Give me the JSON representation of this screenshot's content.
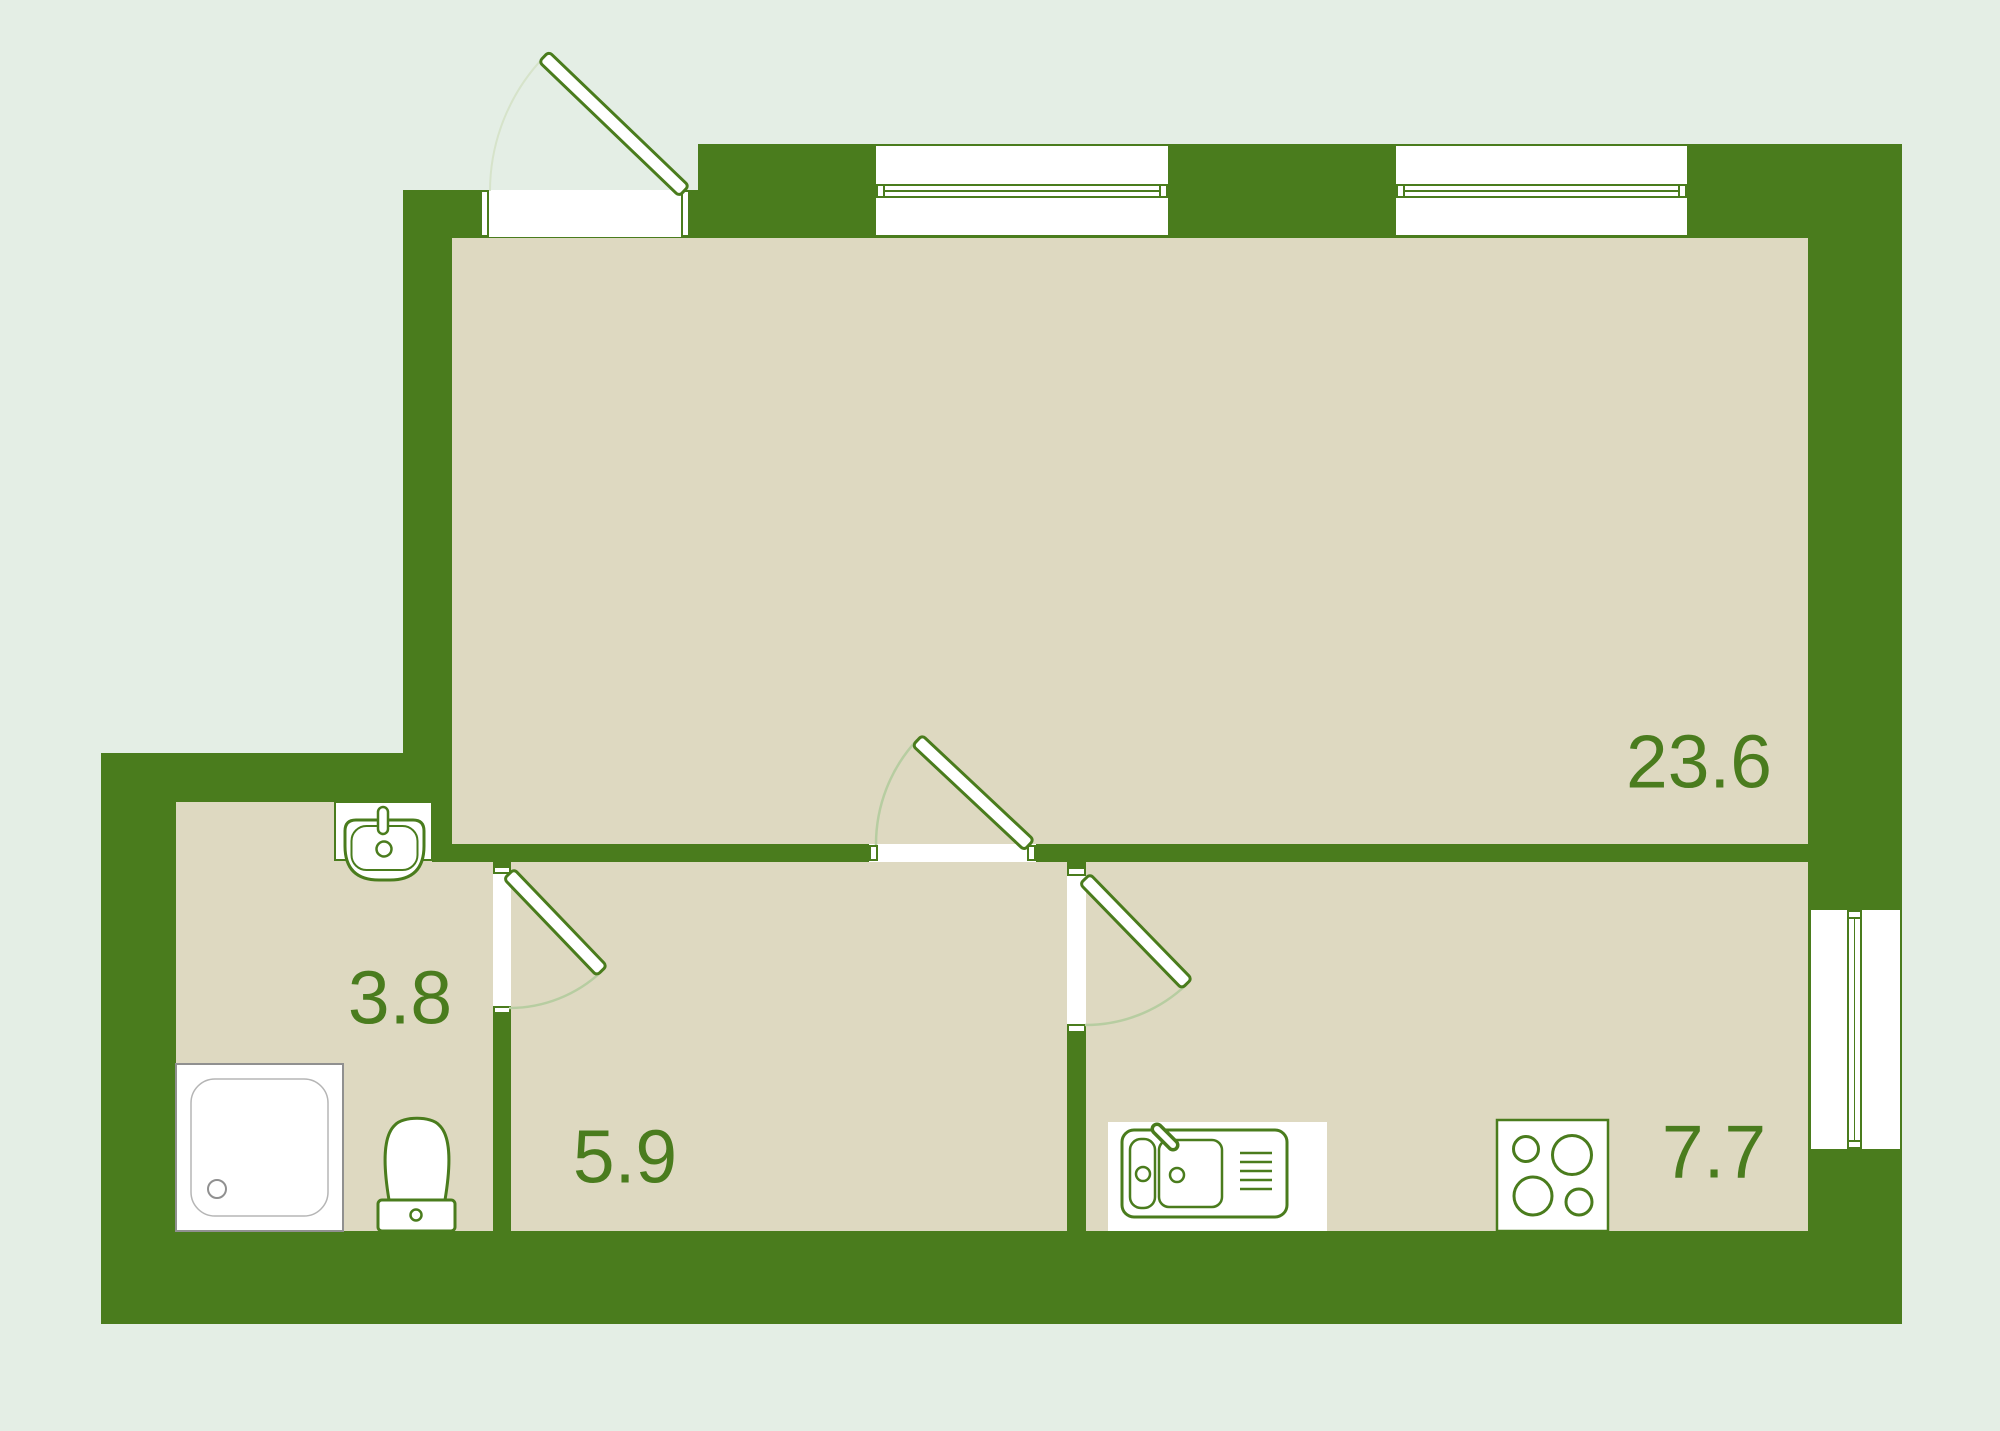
{
  "plan": {
    "rooms": [
      {
        "id": "living-room",
        "area": "23.6"
      },
      {
        "id": "bathroom",
        "area": "3.8"
      },
      {
        "id": "hallway",
        "area": "5.9"
      },
      {
        "id": "kitchen",
        "area": "7.7"
      }
    ],
    "fixtures": [
      "bathroom-sink",
      "toilet",
      "shower-tray",
      "kitchen-sink",
      "stove-hob"
    ],
    "openings": {
      "entry_doors": 1,
      "interior_doors": 3,
      "windows": 3
    },
    "colors": {
      "wall": "#4a7c1d",
      "floor": "#ded9c1",
      "background": "#e4eee5",
      "label": "#4a7c1e",
      "door_arc": "#b7cda1",
      "shower_outline": "#909090"
    }
  }
}
